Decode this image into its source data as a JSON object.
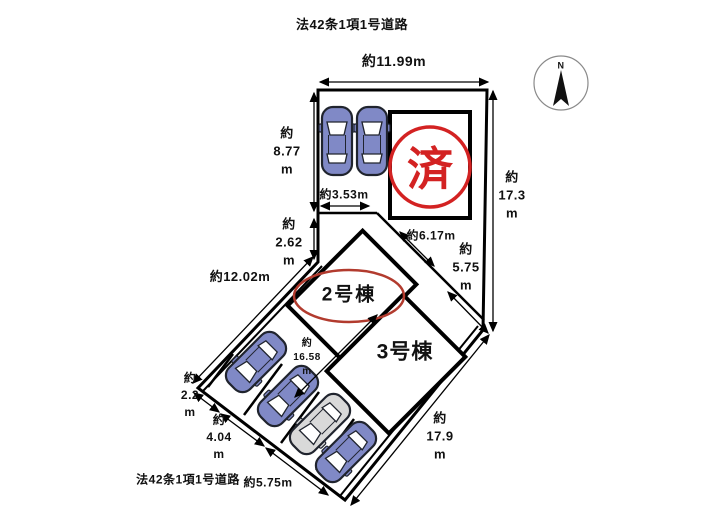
{
  "roads": {
    "top": "法42条1項1号道路",
    "bottom": "法42条1項1号道路"
  },
  "compass": {
    "north": "N"
  },
  "units": {
    "unit1_stamp": "済",
    "unit2_label": "2号棟",
    "unit3_label": "3号棟"
  },
  "dimensions": {
    "top_width": "約11.99m",
    "left_height_upper": "約\n8.77\nm",
    "left_height_lower": "約\n2.62\nm",
    "parking_width": "約3.53m",
    "right_height": "約\n17.3\nm",
    "inner_diag_a": "約6.17m",
    "inner_diag_b": "約\n5.75\nm",
    "west_boundary": "約12.02m",
    "driveway_length": "約\n16.58\nm",
    "frontage_a": "約\n2.2\nm",
    "frontage_b": "約\n4.04\nm",
    "frontage_c": "約5.75m",
    "southeast_boundary": "約\n17.9\nm"
  },
  "colors": {
    "car_blue": "#8089c6",
    "car_gray": "#d9d9d9",
    "stamp_red": "#d32222",
    "circle_red": "#b23b2e"
  }
}
